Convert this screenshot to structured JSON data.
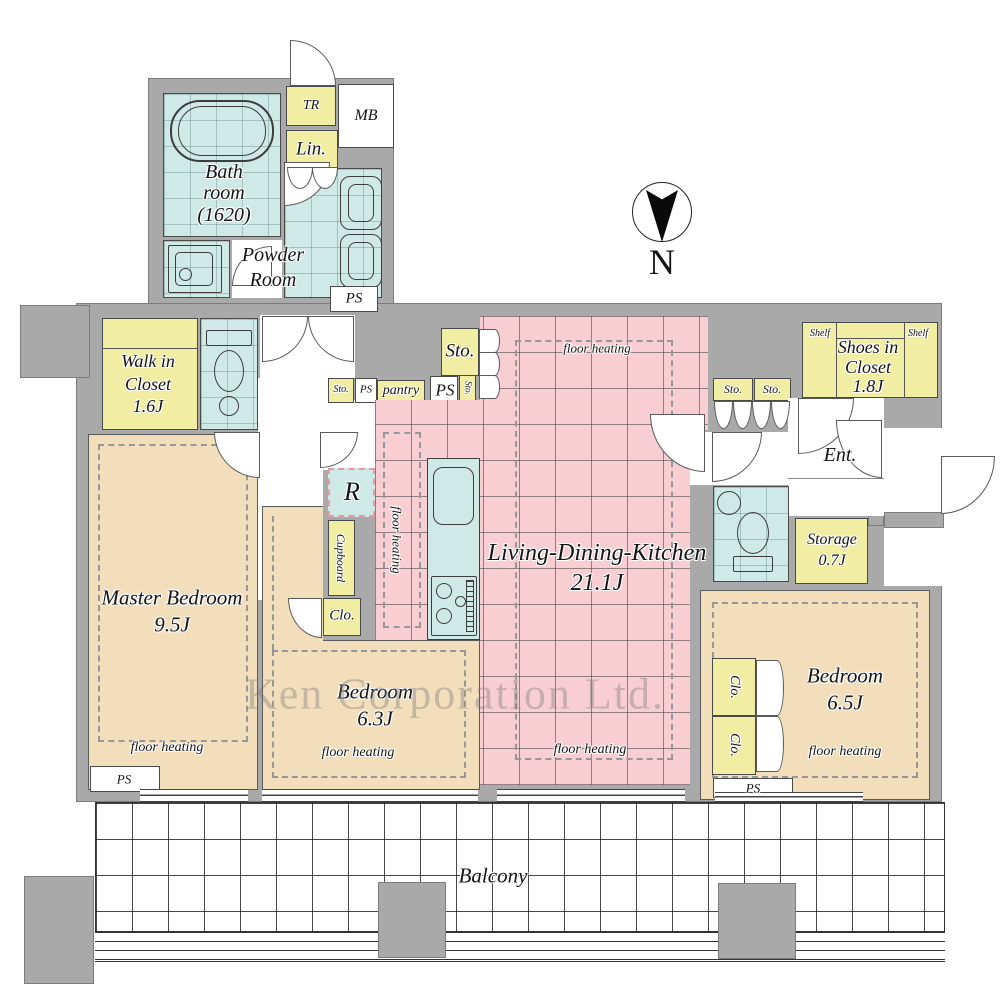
{
  "watermark": "Ken Corporation Ltd.",
  "compass": {
    "north": "N"
  },
  "colors": {
    "wall": "#a9a9a9",
    "wet_area": "#cfe9e6",
    "closet": "#f1eda3",
    "bedroom": "#f2debb",
    "ldk": "#f8ced2"
  },
  "rooms": {
    "bath": {
      "l1": "Bath",
      "l2": "room",
      "l3": "(1620)"
    },
    "powder": {
      "l1": "Powder",
      "l2": "Room"
    },
    "wic": {
      "l1": "Walk in",
      "l2": "Closet",
      "l3": "1.6J"
    },
    "master": {
      "name": "Master Bedroom",
      "size": "9.5J"
    },
    "bedroom63": {
      "name": "Bedroom",
      "size": "6.3J"
    },
    "bedroom65": {
      "name": "Bedroom",
      "size": "6.5J"
    },
    "ldk": {
      "name": "Living-Dining-Kitchen",
      "size": "21.1J"
    },
    "shoes": {
      "l1": "Shoes in",
      "l2": "Closet",
      "l3": "1.8J"
    },
    "storage": {
      "name": "Storage",
      "size": "0.7J"
    },
    "entrance": "Ent.",
    "balcony": "Balcony"
  },
  "labels": {
    "tr": "TR",
    "mb": "MB",
    "lin": "Lin.",
    "ps": "PS",
    "sto": "Sto.",
    "pantry": "pantry",
    "refrigerator": "R",
    "cupboard": "Cupboard",
    "clo": "Clo.",
    "shelf": "Shelf",
    "floor_heating": "floor heating"
  }
}
